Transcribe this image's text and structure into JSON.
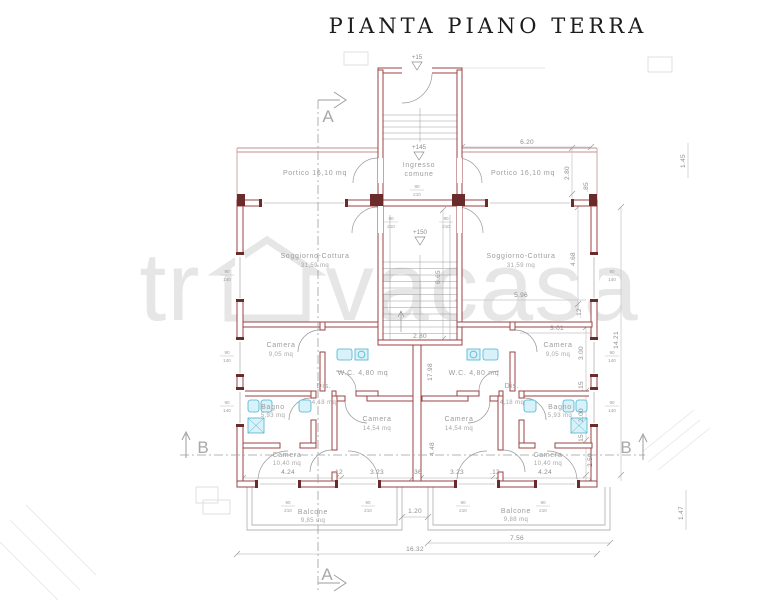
{
  "title": "PIANTA PIANO TERRA",
  "watermark": {
    "left": "tr",
    "right": "vacasa"
  },
  "section_markers": {
    "a": "A",
    "b": "B"
  },
  "level_markers": {
    "street": "+15",
    "entrance": "+145",
    "stair_mid": "+150"
  },
  "rooms": {
    "portico_left": {
      "label": "Portico 16,10 mq"
    },
    "portico_right": {
      "label": "Portico 16,10 mq"
    },
    "ingresso_comune": {
      "line1": "Ingresso",
      "line2": "comune"
    },
    "soggiorno_left": {
      "name": "Soggiorno-Cottura",
      "area": "31,59 mq"
    },
    "soggiorno_right": {
      "name": "Soggiorno-Cottura",
      "area": "31,59 mq"
    },
    "camera_top_left": {
      "name": "Camera",
      "area": "9,05 mq"
    },
    "camera_top_right": {
      "name": "Camera",
      "area": "9,05 mq"
    },
    "wc_left": {
      "label": "W.C. 4,80 mq"
    },
    "wc_right": {
      "label": "W.C. 4,80 mq"
    },
    "dis_left": {
      "name": "Dis.",
      "area": "4,18 mq"
    },
    "dis_right": {
      "name": "Dis.",
      "area": "4,18 mq"
    },
    "bagno_left": {
      "name": "Bagno",
      "area": "5,93 mq"
    },
    "bagno_right": {
      "name": "Bagno",
      "area": "5,93 mq"
    },
    "camera_mid_left": {
      "name": "Camera",
      "area": "14,54 mq"
    },
    "camera_mid_right": {
      "name": "Camera",
      "area": "14,54 mq"
    },
    "camera_bottom_left": {
      "name": "Camera",
      "area": "10,40 mq"
    },
    "camera_bottom_right": {
      "name": "Camera",
      "area": "10,40 mq"
    },
    "balcone_left": {
      "name": "Balcone",
      "area": "9,85 mq"
    },
    "balcone_right": {
      "name": "Balcone",
      "area": "9,88 mq"
    }
  },
  "dims": {
    "portico_width": "6.20",
    "portico_depth": "2.80",
    "pier": ".85",
    "side_top_right": "1.45",
    "soggiorno_depth": "4.68",
    "soggiorno_width": "5.96",
    "wall_12_right": ".12",
    "camera_width_right": "3.01",
    "apt_depth": "14.21",
    "camera_depth": "3.00",
    "wall_15_a": ".15",
    "bagno_depth": "2.00",
    "wall_15_b": ".15",
    "camera_bottom_depth": "2.50",
    "stair_depth": "6.65",
    "stair_width": "2.80",
    "core_depth": "17.98",
    "core_lower": "4.48",
    "bottom_424_left": "4.24",
    "bottom_12_left": ".12",
    "bottom_323_left": "3.23",
    "bottom_36": ".36",
    "bottom_323_right": "3.23",
    "bottom_12_right": ".12",
    "bottom_424_right": "4.24",
    "balcony_gap": "1.20",
    "balcony_right_width": "7.56",
    "total_width": "16.32",
    "balcony_depth": "1.47"
  },
  "openings": {
    "window_w": "90",
    "window_h": "140",
    "door_w": "90",
    "door_h": "210"
  },
  "colors": {
    "wall": "#9b4343",
    "fixture": "#4ab3d1",
    "dimline": "#c4c4c4",
    "watermark": "#e2e2e2"
  }
}
